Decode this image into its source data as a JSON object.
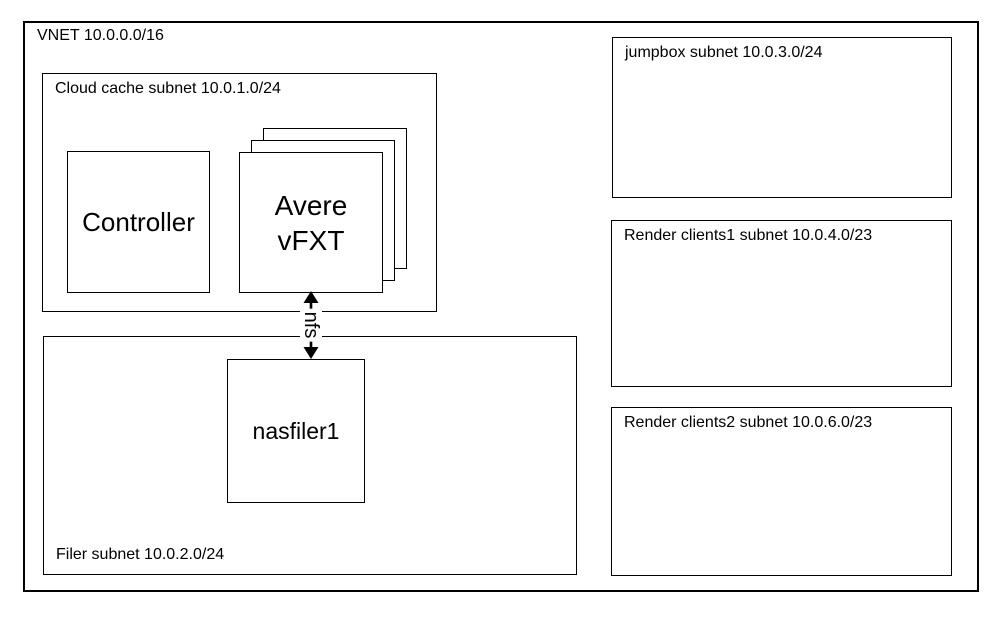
{
  "diagram": {
    "title": "Azure VNET rendering architecture diagram",
    "vnet": {
      "label": "VNET 10.0.0.0/16"
    },
    "cloud_cache_subnet": {
      "label": "Cloud cache subnet 10.0.1.0/24"
    },
    "controller": {
      "label": "Controller"
    },
    "avere_vfxt": {
      "line1": "Avere",
      "line2": "vFXT",
      "stack_count": 3
    },
    "nfs_link": {
      "label": "nfs",
      "type": "double-headed-arrow"
    },
    "filer_subnet": {
      "label": "Filer subnet 10.0.2.0/24"
    },
    "nasfiler": {
      "label": "nasfiler1"
    },
    "jumpbox_subnet": {
      "label": "jumpbox subnet 10.0.3.0/24"
    },
    "render_clients1_subnet": {
      "label": "Render clients1 subnet 10.0.4.0/23"
    },
    "render_clients2_subnet": {
      "label": "Render clients2 subnet 10.0.6.0/23"
    },
    "colors": {
      "line": "#000000",
      "background": "#ffffff"
    }
  }
}
